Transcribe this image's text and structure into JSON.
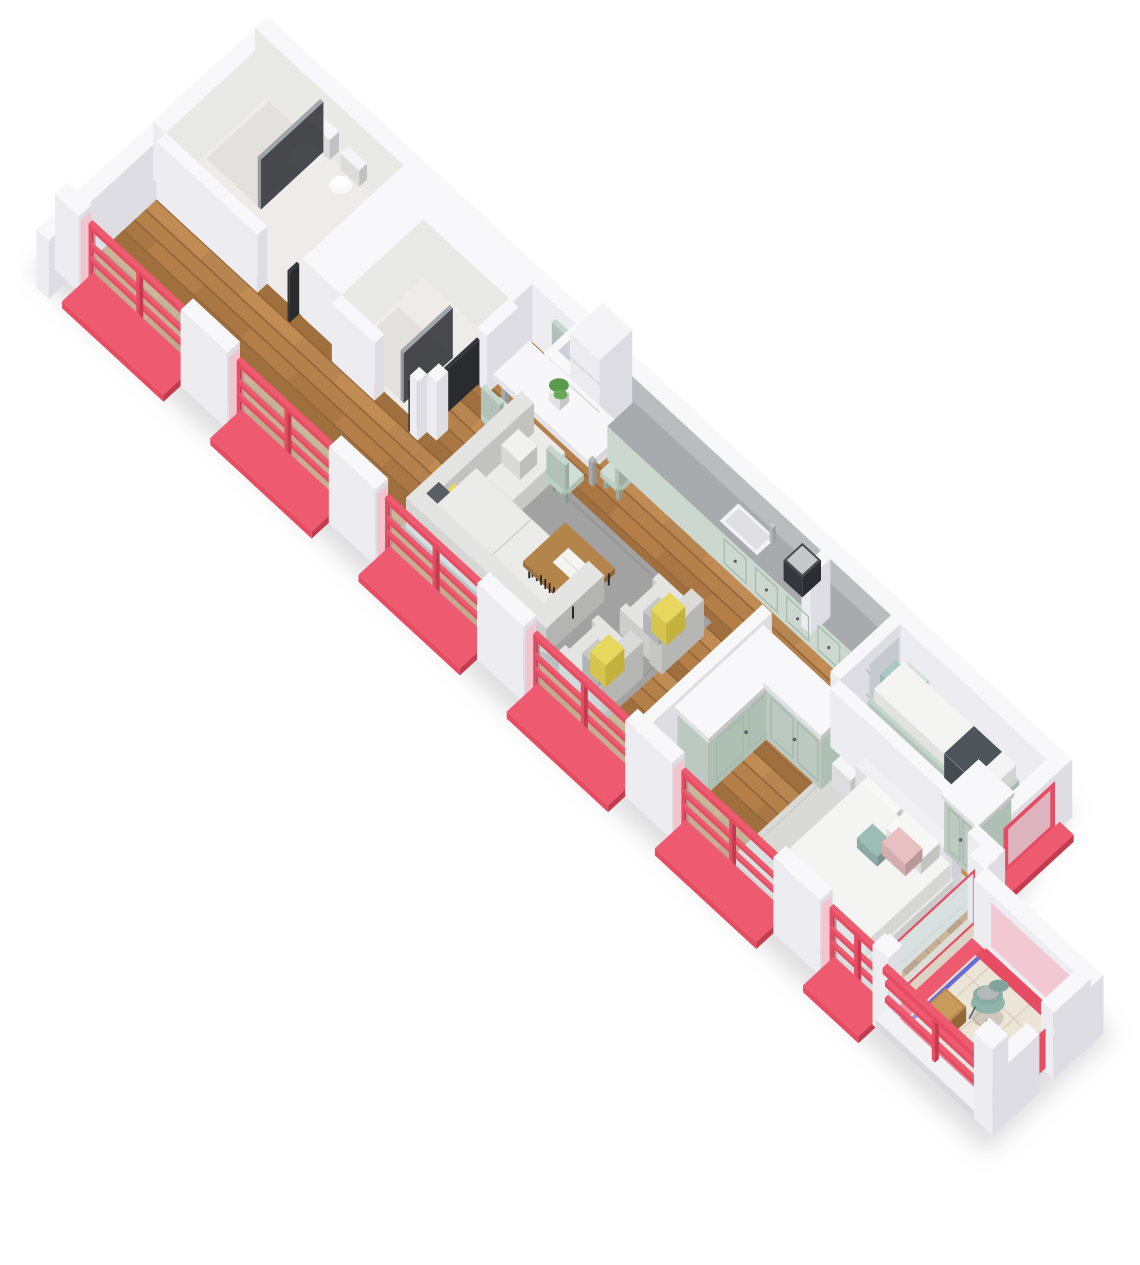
{
  "meta": {
    "title": "3D isometric apartment floor plan render",
    "style": "cutaway axonometric view, white walls, red window frames",
    "background": "#ffffff"
  },
  "palette": {
    "background": "#ffffff",
    "wall": "#f8f8fa",
    "wallFace": "#ededf1",
    "wallSide": "#dddde3",
    "wallDark": "#cfcfd7",
    "marble": "#e9e9e6",
    "bathFloor": "#edece9",
    "showerFloor": "#e2e1dd",
    "red": "#e64d62",
    "redTop": "#ee5a70",
    "redDark": "#c43a4f",
    "pink": "#f2c4ce",
    "mint": "#ccdbd1",
    "mintDoor": "#c5d5cb",
    "mintDark": "#aebfb4",
    "mintPanel": "#a3b8ab",
    "counter": "#a7abad",
    "kitchenBack": "#b9bdbf",
    "glass": "#d9e9ee",
    "glassDark": "#9aa0a4",
    "sofa": "#e4e4e2",
    "sofaSeat": "#ebebe9",
    "sofaBack": "#d6d6d4",
    "rugLiving": "#a2a2a2",
    "rugMaster": "#d9d9d5",
    "yellow": "#e8d75f",
    "pillowGray": "#c5c9cc",
    "tealPillow": "#a9c9c3",
    "blush": "#e9c0c1",
    "darkGray": "#4d555b",
    "beige": "#e6d9c4",
    "linen": "#f4f4f2",
    "tableWood": "#b4854a",
    "frameBlack": "#232426",
    "tileBalcony": "#ece4d6",
    "tileLine": "#d9cfbe",
    "blue": "#6b6bd6",
    "tealChair": "#8fb4ac",
    "green": "#5a9b4e",
    "greenDark": "#4e8c44",
    "greenLight": "#69aa58",
    "grayAccent": "#c6c9cd",
    "silver": "#c6c8ca",
    "oven": "#c3c5c7",
    "cooktop": "#202124",
    "woodA": "#b5814b",
    "woodB": "#aa7744",
    "woodC": "#c08c54",
    "woodD": "#9f6f3e",
    "woodLine": "#8f6136",
    "boardWood": "#c79050",
    "dark": "#35363a",
    "white": "#ffffff",
    "shadow": "#9a9aa0"
  },
  "scene": {
    "rooms": [
      {
        "id": "entrance-hallway",
        "label": "Hallway",
        "floor": "wood",
        "features": [
          "french-windows"
        ]
      },
      {
        "id": "bathroom",
        "label": "Bathroom",
        "floor": "tile",
        "furniture": [
          "toilet",
          "bidet",
          "shower-glass"
        ]
      },
      {
        "id": "shower-room",
        "label": "Shower room",
        "floor": "tile",
        "furniture": [
          "shower-glass"
        ]
      },
      {
        "id": "dining-area",
        "label": "Dining area",
        "floor": "wood",
        "furniture": [
          "dining-table",
          "six-chairs",
          "plant"
        ]
      },
      {
        "id": "kitchen",
        "label": "Kitchen",
        "floor": "wood",
        "furniture": [
          "fridge",
          "oven-cooktop",
          "cabinets",
          "sink",
          "coffee-machine",
          "cutting-board"
        ]
      },
      {
        "id": "living-room",
        "label": "Living room",
        "floor": "wood",
        "furniture": [
          "corner-sofa",
          "two-armchairs",
          "coffee-table",
          "rug",
          "book"
        ]
      },
      {
        "id": "wardrobe-hall",
        "label": "Wardrobe hall",
        "floor": "wood",
        "furniture": [
          "l-shaped-wardrobe"
        ]
      },
      {
        "id": "bedroom-kids",
        "label": "Kids bedroom",
        "floor": "wood",
        "furniture": [
          "single-bed",
          "wardrobe",
          "pillows"
        ]
      },
      {
        "id": "bedroom-master",
        "label": "Master bedroom",
        "floor": "wood",
        "furniture": [
          "double-bed",
          "nightstand",
          "plant",
          "rug",
          "wardrobe-row"
        ]
      },
      {
        "id": "balcony-loggia",
        "label": "Balcony",
        "floor": "tile-grid",
        "furniture": [
          "tub-chair",
          "side-table"
        ]
      }
    ],
    "windows": {
      "french_windows_left": 6,
      "kids_bedroom_window": 1,
      "balcony_glazing": true,
      "frame_color": "#e64d62"
    }
  }
}
